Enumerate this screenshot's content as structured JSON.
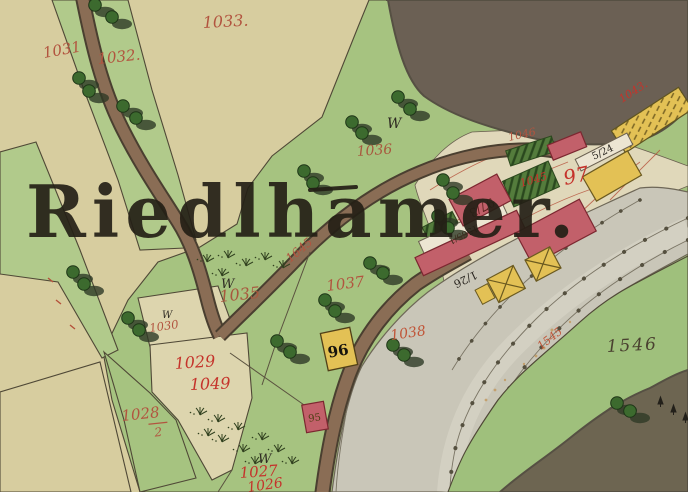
{
  "map": {
    "place_name": "Riedlhamer.",
    "w_mark": "W",
    "parcel_labels": {
      "p1033": "1033.",
      "p1031": "1031",
      "p1032": "1032.",
      "p1036": "1036",
      "p1035": "1035",
      "p1030": "1030",
      "p1037": "1037",
      "p1038": "1038",
      "p1029": "1029",
      "p1049": "1049",
      "p1028_num": "1028",
      "p1028_den": "2",
      "p1027": "1027",
      "p1026": "1026",
      "p1546": "1546",
      "p1046": "1046",
      "p1045": "1045",
      "p1043": "1043.",
      "p97": "97",
      "p1545": "1545",
      "road_1645": "1645"
    },
    "house_labels": {
      "h96": "96",
      "h95": "95",
      "h97_3": "97/3",
      "h1_26": "1/26",
      "h5_24": "5/24",
      "h1565_1": "1565/1"
    },
    "colors": {
      "parchment": "#d7cd9f",
      "field_light": "#ddd5ae",
      "meadow_green": "#a6c380",
      "meadow_green_light": "#b1ca8b",
      "forest_gray_brown": "#6b6054",
      "forest_olive": "#6d6551",
      "road_brown": "#8a6d55",
      "road_edge": "#4a3f30",
      "stream_gray": "#c9c6b8",
      "building_masonry_red": "#c2606a",
      "building_wood_yellow": "#e3c155",
      "garden_dark_green": "#547c3c",
      "label_red": "#b2543f",
      "label_bright_red": "#c5332b",
      "label_black": "#241f16"
    }
  }
}
